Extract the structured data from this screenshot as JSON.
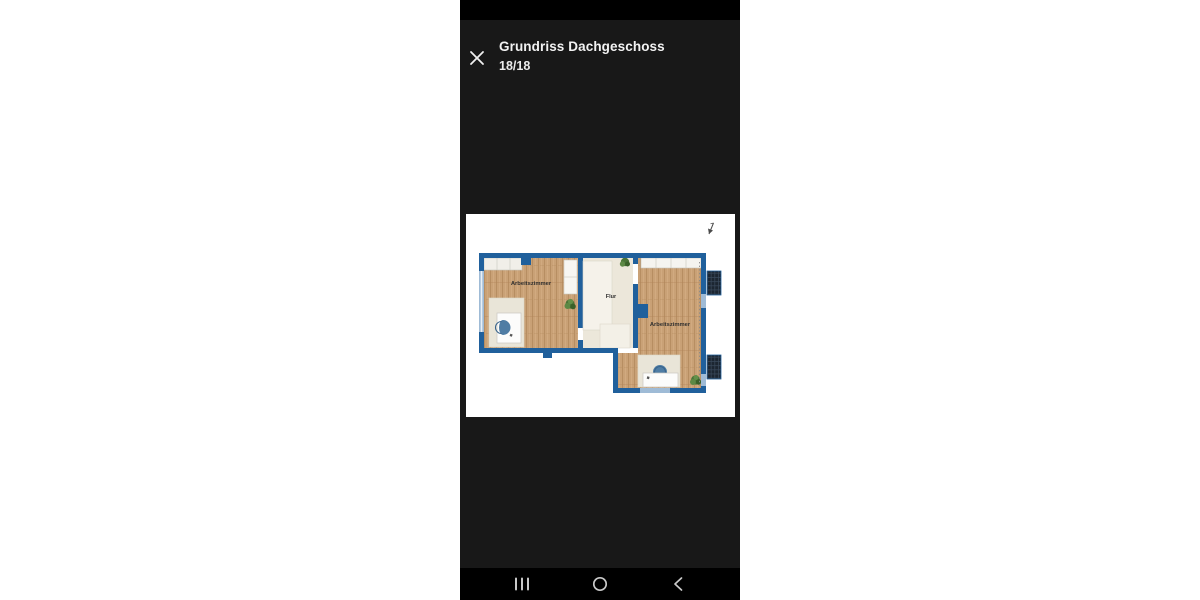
{
  "phone": {
    "header": {
      "title": "Grundriss Dachgeschoss",
      "counter": "18/18"
    },
    "floorplan": {
      "rooms": [
        {
          "label": "Arbeitszimmer"
        },
        {
          "label": "Flur"
        },
        {
          "label": "Arbeitszimmer"
        }
      ],
      "colors": {
        "wall": "#20609c",
        "window": "#9fbbd6",
        "wood": "#c9a176",
        "hallway_floor": "#ece7da",
        "rug": "#e9e5d8",
        "chair": "#4f7da4",
        "plant": "#4a7437",
        "solar_panel": "#1c2631"
      }
    },
    "navbar": {
      "icons": [
        "recents-icon",
        "home-icon",
        "back-icon"
      ]
    }
  }
}
